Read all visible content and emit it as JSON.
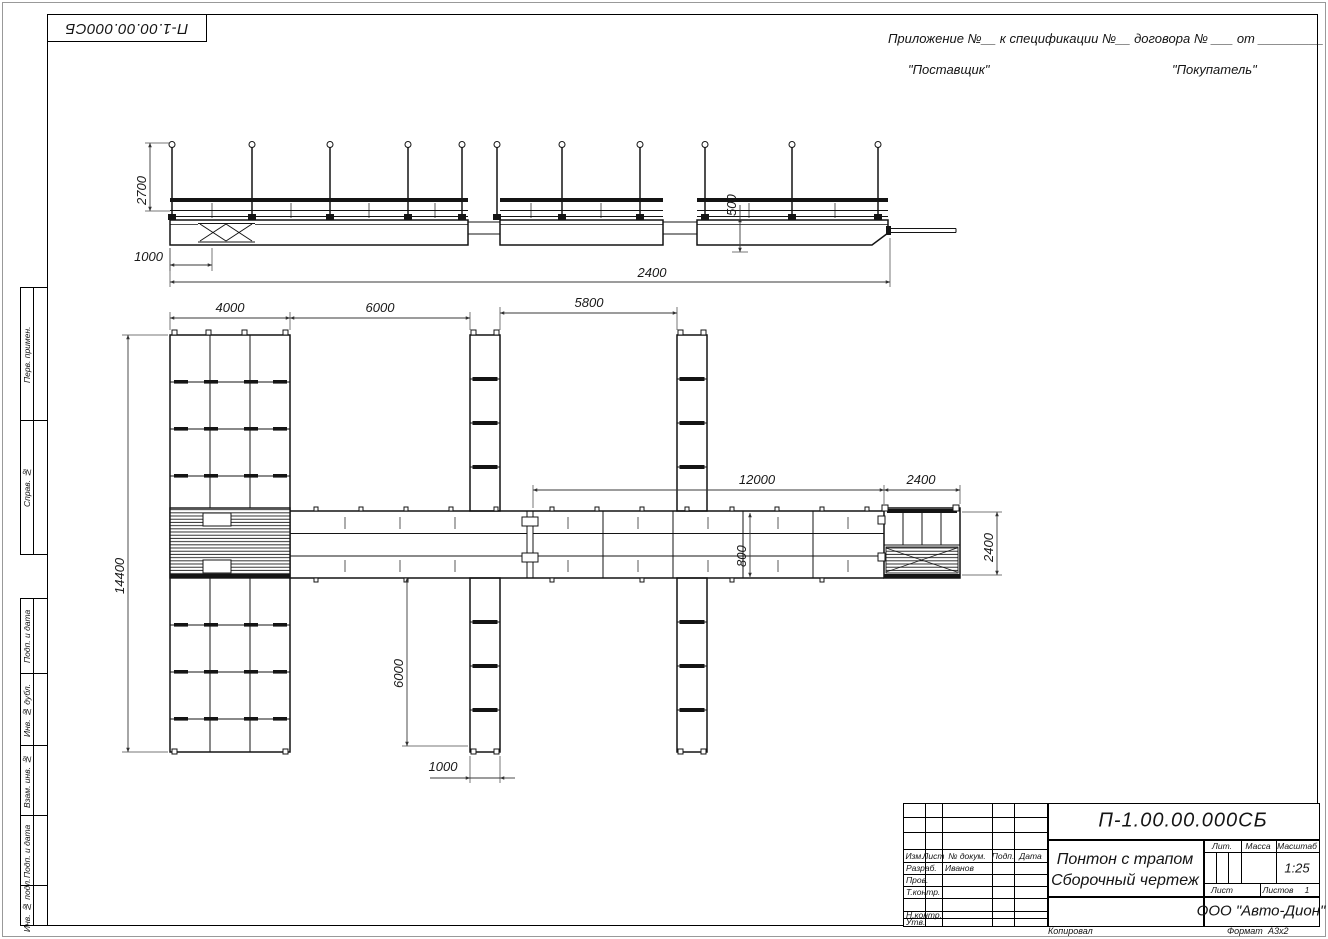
{
  "document": {
    "number": "П-1.00.00.000СБ",
    "title_line1": "Понтон с трапом",
    "title_line2": "Сборочный чертеж",
    "scale": "1:25",
    "company": "ООО \"Авто-Дион\"",
    "author": "Иванов",
    "sheets_value": "1",
    "format_value": "А3х2"
  },
  "header": {
    "appendix": "Приложение №__    к спецификации №__   договора № ___  от  _________",
    "supplier": "\"Поставщик\"",
    "buyer": "\"Покупатель\""
  },
  "sidebar": {
    "items": [
      {
        "label": "Перв. примен."
      },
      {
        "label": "Справ. №"
      },
      {
        "label": "Подп. и дата"
      },
      {
        "label": "Инв. № дубл."
      },
      {
        "label": "Взам. инв. №"
      },
      {
        "label": "Подп. и дата"
      },
      {
        "label": "Инв. № подл."
      }
    ]
  },
  "stamp": {
    "izm": "Изм.",
    "list": "Лист",
    "ndok": "№ докум.",
    "podp": "Подп.",
    "data": "Дата",
    "razrab": "Разраб.",
    "prov": "Пров.",
    "tkontr": "Т.контр.",
    "nkontr": "Н.контр.",
    "utv": "Утв.",
    "lit": "Лит.",
    "massa": "Масса",
    "masshtab": "Масштаб",
    "list2": "Лист",
    "listov": "Листов",
    "kopiroval": "Копировал",
    "format": "Формат"
  },
  "dims": {
    "elev_height": "2700",
    "elev_offset": "1000",
    "elev_length": "2400",
    "float_height": "500",
    "pier_width": "4000",
    "bay1": "6000",
    "bay2": "5800",
    "walkway_len": "12000",
    "platform_len": "2400",
    "total_width": "14400",
    "walk_width": "800",
    "finger_len": "6000",
    "finger_width": "1000",
    "platform_depth": "2400"
  }
}
